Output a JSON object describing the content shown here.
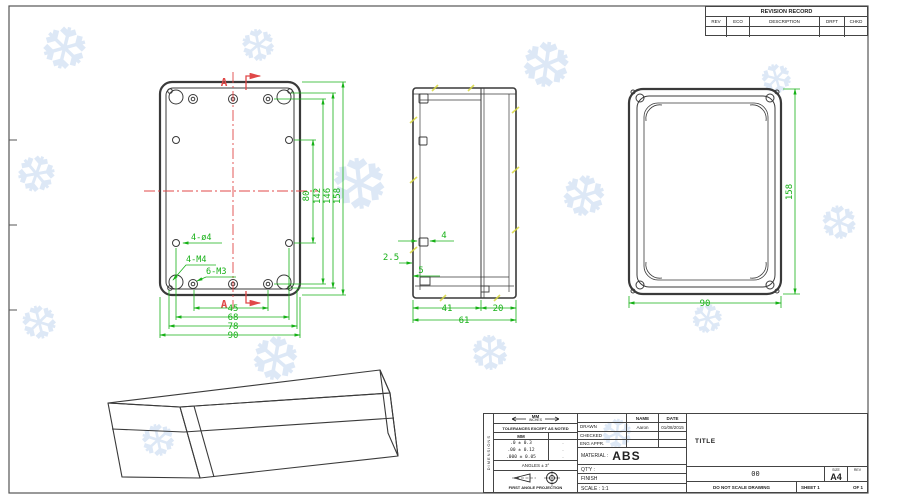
{
  "colors": {
    "dimension_green": "#17b117",
    "centerline_red": "#e04848",
    "line_dark": "#3a3a3a",
    "watermark_blue": "#dde8f6",
    "tick_yellow": "#d9d93f"
  },
  "revision": {
    "title": "REVISION RECORD",
    "cols": [
      "REV",
      "ECO",
      "DESCRIPTION",
      "DRFT",
      "CHKD"
    ]
  },
  "front": {
    "section": "A",
    "dims_vertical": [
      "80",
      "142",
      "146",
      "158"
    ],
    "dims_bottom": [
      "45",
      "68",
      "78",
      "90"
    ],
    "labels": [
      "4-ø4",
      "4-M4",
      "6-M3"
    ]
  },
  "side": {
    "dim_tab": "4",
    "dim_wall": "2.5",
    "dim_lip": "5",
    "dims_bottom": [
      "41",
      "20",
      "61"
    ]
  },
  "back": {
    "dim_height": "158",
    "dim_width": "90"
  },
  "tb": {
    "side_strip": "DIMENSIONS",
    "units_top": "MM",
    "units_sub": "INCHES",
    "tol_note": "TOLERANCES EXCEPT AS NOTED",
    "tol_header": "MM",
    "tol_rows": [
      ".0 ± 0.3",
      ".00 ± 0.12",
      ".000 ± 0.05"
    ],
    "tol_marks": [
      "·",
      "·",
      "·"
    ],
    "angles": "ANGLES ± 3°",
    "projection_label": "FIRST ANGLE PROJECTION",
    "col_name": "NAME",
    "col_date": "DATE",
    "row_drawn": "DRAWN",
    "drawn_name": "Aaron",
    "drawn_date": "01/08/2015",
    "row_checked": "CHECKED",
    "row_eng": "ENG APPR.",
    "material_label": "MATERIAL :",
    "material_value": "ABS",
    "qty": "QT'Y :",
    "finish": "FINISH",
    "scale": "SCALE : 1:1",
    "title": "TITLE",
    "number": "00",
    "size_label": "SIZE",
    "size_value": "A4",
    "rev_label": "REV",
    "no_scale": "DO NOT SCALE DRAWING",
    "sheet": "SHEET 1",
    "of": "OF 1"
  },
  "watermark": {
    "glyph": "❆"
  }
}
